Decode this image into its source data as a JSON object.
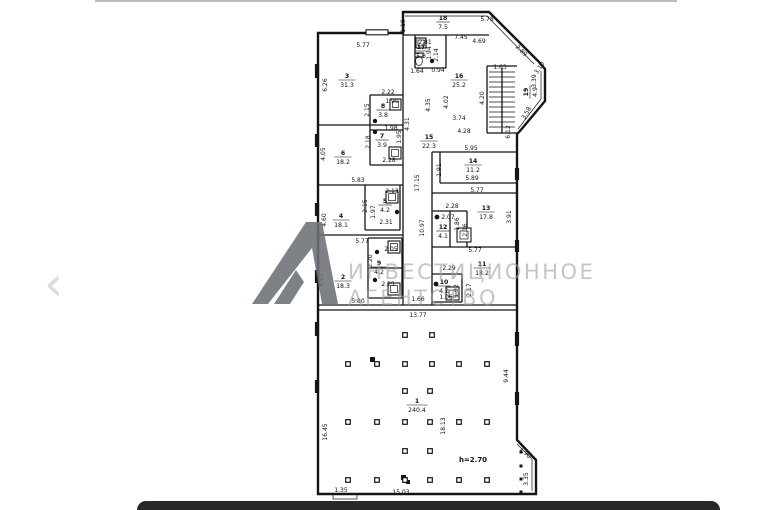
{
  "viewer": {
    "prev_icon": "‹",
    "bottom_bar_color": "#28282b",
    "top_line_color": "#bdbdbd"
  },
  "watermark": {
    "line1": "ИНВЕСТИЦИОННОЕ",
    "line2": "АГЕНТСТВО",
    "text_color": "#9aa0a6",
    "logo_color": "#6d7176"
  },
  "plan": {
    "line_color": "#151515",
    "note": {
      "t": "h=2.70",
      "x": 473,
      "y": 460
    },
    "rooms": [
      {
        "n": "18",
        "a": "7.5",
        "x": 443,
        "y": 21
      },
      {
        "n": "17",
        "a": "5.3",
        "x": 421,
        "y": 50
      },
      {
        "n": "16",
        "a": "25.2",
        "x": 459,
        "y": 79
      },
      {
        "n": "19",
        "a": "4.9",
        "x": 529,
        "y": 92,
        "r": -90
      },
      {
        "n": "3",
        "a": "31.3",
        "x": 347,
        "y": 79
      },
      {
        "n": "8",
        "a": "3.8",
        "x": 383,
        "y": 109
      },
      {
        "n": "7",
        "a": "3.9",
        "x": 382,
        "y": 139
      },
      {
        "n": "6",
        "a": "18.2",
        "x": 343,
        "y": 156
      },
      {
        "n": "15",
        "a": "22.3",
        "x": 429,
        "y": 140
      },
      {
        "n": "14",
        "a": "11.2",
        "x": 473,
        "y": 164
      },
      {
        "n": "5",
        "a": "4.2",
        "x": 385,
        "y": 204
      },
      {
        "n": "4",
        "a": "18.1",
        "x": 341,
        "y": 219
      },
      {
        "n": "13",
        "a": "17.8",
        "x": 486,
        "y": 211
      },
      {
        "n": "12",
        "a": "4.1",
        "x": 443,
        "y": 230
      },
      {
        "n": "9",
        "a": "4.2",
        "x": 379,
        "y": 266
      },
      {
        "n": "2",
        "a": "18.3",
        "x": 343,
        "y": 280
      },
      {
        "n": "11",
        "a": "18.2",
        "x": 482,
        "y": 267
      },
      {
        "n": "10",
        "a": "4.2",
        "x": 444,
        "y": 285
      },
      {
        "n": "1",
        "a": "240.4",
        "x": 417,
        "y": 404
      }
    ],
    "dims": [
      {
        "t": "1.19",
        "x": 405,
        "y": 24,
        "r": -90
      },
      {
        "t": "5.78",
        "x": 487,
        "y": 19
      },
      {
        "t": "7.45",
        "x": 461,
        "y": 37
      },
      {
        "t": "4.69",
        "x": 479,
        "y": 41
      },
      {
        "t": "2.89",
        "x": 520,
        "y": 50,
        "r": 45
      },
      {
        "t": "5.77",
        "x": 363,
        "y": 45
      },
      {
        "t": "6.26",
        "x": 327,
        "y": 83,
        "r": -90
      },
      {
        "t": "2.81",
        "x": 425,
        "y": 42
      },
      {
        "t": "1.94",
        "x": 431,
        "y": 51,
        "r": -90
      },
      {
        "t": "2.14",
        "x": 438,
        "y": 53,
        "r": -90
      },
      {
        "t": "1.64",
        "x": 417,
        "y": 71
      },
      {
        "t": "0.94",
        "x": 438,
        "y": 70
      },
      {
        "t": "1.63",
        "x": 500,
        "y": 67
      },
      {
        "t": "4.02",
        "x": 448,
        "y": 100,
        "r": -90
      },
      {
        "t": "4.35",
        "x": 430,
        "y": 103,
        "r": -90
      },
      {
        "t": "4.20",
        "x": 484,
        "y": 96,
        "r": -90
      },
      {
        "t": "3.74",
        "x": 459,
        "y": 118
      },
      {
        "t": "4.28",
        "x": 464,
        "y": 131
      },
      {
        "t": "6.12",
        "x": 510,
        "y": 130,
        "r": -90
      },
      {
        "t": "3.39",
        "x": 536,
        "y": 79,
        "r": -90
      },
      {
        "t": "3.10",
        "x": 541,
        "y": 67,
        "r": -55
      },
      {
        "t": "3.58",
        "x": 528,
        "y": 112,
        "r": -60
      },
      {
        "t": "2.22",
        "x": 388,
        "y": 92
      },
      {
        "t": "1.90",
        "x": 392,
        "y": 101
      },
      {
        "t": "2.15",
        "x": 369,
        "y": 108,
        "r": -90
      },
      {
        "t": "1.98",
        "x": 391,
        "y": 128
      },
      {
        "t": "2.18",
        "x": 370,
        "y": 140,
        "r": -90
      },
      {
        "t": "1.95",
        "x": 401,
        "y": 135,
        "r": -90
      },
      {
        "t": "2.28",
        "x": 389,
        "y": 160
      },
      {
        "t": "4.31",
        "x": 409,
        "y": 122,
        "r": -90
      },
      {
        "t": "4.05",
        "x": 325,
        "y": 152,
        "r": -90
      },
      {
        "t": "5.83",
        "x": 358,
        "y": 180
      },
      {
        "t": "17.15",
        "x": 419,
        "y": 181,
        "r": -90
      },
      {
        "t": "10.97",
        "x": 424,
        "y": 226,
        "r": -90
      },
      {
        "t": "5.95",
        "x": 471,
        "y": 148
      },
      {
        "t": "1.91",
        "x": 441,
        "y": 168,
        "r": -90
      },
      {
        "t": "5.89",
        "x": 472,
        "y": 178
      },
      {
        "t": "5.77",
        "x": 477,
        "y": 190
      },
      {
        "t": "2.28",
        "x": 452,
        "y": 206
      },
      {
        "t": "2.07",
        "x": 448,
        "y": 217
      },
      {
        "t": "1.86",
        "x": 459,
        "y": 222,
        "r": -90
      },
      {
        "t": "2.16",
        "x": 467,
        "y": 228,
        "r": -90
      },
      {
        "t": "3.91",
        "x": 511,
        "y": 215,
        "r": -90
      },
      {
        "t": "2.13",
        "x": 392,
        "y": 191
      },
      {
        "t": "2.15",
        "x": 367,
        "y": 204,
        "r": -90
      },
      {
        "t": "1.97",
        "x": 375,
        "y": 210,
        "r": -90
      },
      {
        "t": "2.31",
        "x": 386,
        "y": 222
      },
      {
        "t": "4.60",
        "x": 326,
        "y": 218,
        "r": -90
      },
      {
        "t": "5.77",
        "x": 362,
        "y": 241
      },
      {
        "t": "2.05",
        "x": 391,
        "y": 249
      },
      {
        "t": "2.20",
        "x": 372,
        "y": 259,
        "r": -90
      },
      {
        "t": "2.25",
        "x": 388,
        "y": 284
      },
      {
        "t": "4.61",
        "x": 323,
        "y": 278,
        "r": -90
      },
      {
        "t": "5.80",
        "x": 358,
        "y": 301
      },
      {
        "t": "5.77",
        "x": 475,
        "y": 250
      },
      {
        "t": "2.29",
        "x": 449,
        "y": 268
      },
      {
        "t": "1.92",
        "x": 458,
        "y": 289,
        "r": -90
      },
      {
        "t": "2.17",
        "x": 471,
        "y": 288,
        "r": -90
      },
      {
        "t": "1.06",
        "x": 446,
        "y": 297
      },
      {
        "t": "1.66",
        "x": 418,
        "y": 299
      },
      {
        "t": "13.77",
        "x": 418,
        "y": 315
      },
      {
        "t": "16.45",
        "x": 327,
        "y": 430,
        "r": -90
      },
      {
        "t": "18.13",
        "x": 445,
        "y": 424,
        "r": -90
      },
      {
        "t": "9.44",
        "x": 508,
        "y": 374,
        "r": -90
      },
      {
        "t": "3.35",
        "x": 528,
        "y": 477,
        "r": -90
      },
      {
        "t": "1.90",
        "x": 524,
        "y": 452,
        "r": 45
      },
      {
        "t": "1.35",
        "x": 341,
        "y": 490
      },
      {
        "t": "15.03",
        "x": 401,
        "y": 492
      }
    ],
    "columns": {
      "size": 4.6,
      "rows": [
        {
          "y": 335,
          "xs": [
            405,
            432
          ]
        },
        {
          "y": 364,
          "xs": [
            348,
            377,
            405,
            432,
            459,
            487
          ]
        },
        {
          "y": 391,
          "xs": [
            405,
            430
          ]
        },
        {
          "y": 422,
          "xs": [
            348,
            377,
            405,
            430,
            459,
            487
          ]
        },
        {
          "y": 451,
          "xs": [
            405,
            430
          ]
        },
        {
          "y": 480,
          "xs": [
            348,
            377,
            405,
            430,
            459,
            487
          ]
        }
      ],
      "bay": {
        "x": 521,
        "ys": [
          452,
          466,
          479,
          492
        ],
        "size": 3
      }
    }
  }
}
